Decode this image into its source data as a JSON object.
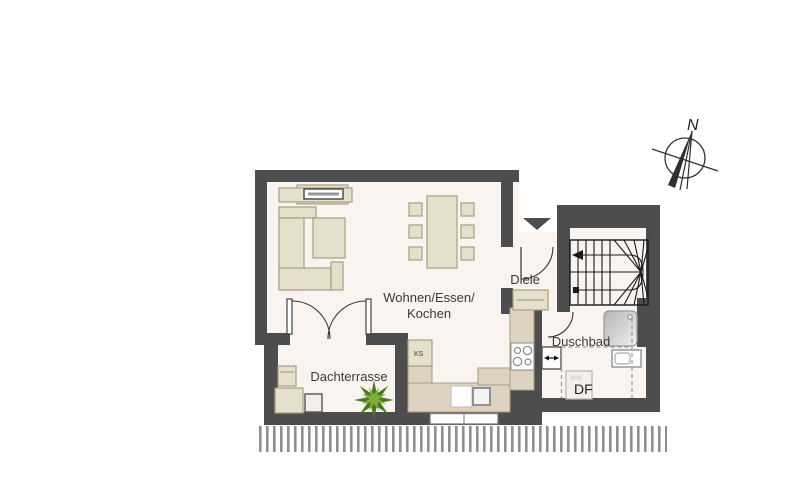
{
  "labels": {
    "room_living_line1": "Wohnen/Essen/",
    "room_living_line2": "Kochen",
    "room_hall": "Diele",
    "room_bath": "Duschbad",
    "room_terrace": "Dachterrasse",
    "fridge": "KS",
    "washing_machine": "WM",
    "roof_window": "DF",
    "compass_north": "N"
  },
  "colors": {
    "wall": "#4d4d4d",
    "floor": "#f9f4f0",
    "furniture": "#e6dfcc",
    "furniture-border": "#a99d81",
    "counter": "#ddd3c0",
    "plant-dark": "#4a7a1e",
    "plant-light": "#7fae3f",
    "text": "#3a3a3a",
    "hatch": "#8f8f8f"
  }
}
